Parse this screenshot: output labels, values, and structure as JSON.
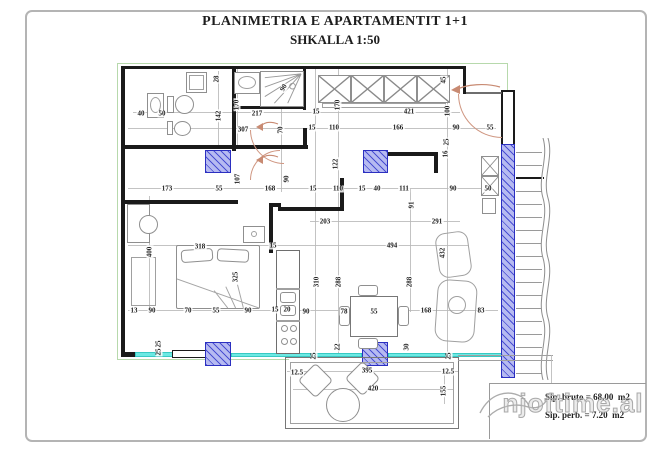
{
  "sheet": {
    "title_line1": "PLANIMETRIA E APARTAMENTIT 1+1",
    "title_line2": "SHKALLA 1:50"
  },
  "info": {
    "bruto": "Sip. bruto = 68.00  m2",
    "perb": "Sip. perb. = 7.20  m2"
  },
  "watermark": "njoftime.al",
  "colors": {
    "wall": "#1a1a1a",
    "column_fill": "#b6baf1",
    "column_border": "#2b2fc0",
    "window": "#6ce9e3",
    "door_arc": "#cf9681",
    "outline_green": "#b7d9ac",
    "furniture": "#8f8f8f",
    "dimension_text": "#1c1c1c"
  },
  "dims": [
    {
      "v": "28",
      "x": 217,
      "y": 79,
      "r": 1
    },
    {
      "v": "170",
      "x": 237,
      "y": 105,
      "r": 1
    },
    {
      "v": "40",
      "x": 141,
      "y": 114
    },
    {
      "v": "50",
      "x": 162,
      "y": 114
    },
    {
      "v": "142",
      "x": 219,
      "y": 116,
      "r": 1
    },
    {
      "v": "217",
      "x": 257,
      "y": 114
    },
    {
      "v": "90",
      "x": 284,
      "y": 88,
      "a": -60
    },
    {
      "v": "307",
      "x": 243,
      "y": 130
    },
    {
      "v": "70",
      "x": 281,
      "y": 130,
      "r": 1
    },
    {
      "v": "15",
      "x": 316,
      "y": 112
    },
    {
      "v": "170",
      "x": 338,
      "y": 105,
      "r": 1
    },
    {
      "v": "421",
      "x": 409,
      "y": 112
    },
    {
      "v": "100",
      "x": 448,
      "y": 111,
      "r": 1
    },
    {
      "v": "45",
      "x": 444,
      "y": 80,
      "r": 1
    },
    {
      "v": "15",
      "x": 312,
      "y": 128
    },
    {
      "v": "110",
      "x": 334,
      "y": 128
    },
    {
      "v": "166",
      "x": 398,
      "y": 128
    },
    {
      "v": "90",
      "x": 456,
      "y": 128
    },
    {
      "v": "55",
      "x": 490,
      "y": 128
    },
    {
      "v": "25",
      "x": 447,
      "y": 142,
      "r": 1
    },
    {
      "v": "16",
      "x": 446,
      "y": 154,
      "r": 1
    },
    {
      "v": "122",
      "x": 336,
      "y": 164,
      "r": 1
    },
    {
      "v": "107",
      "x": 238,
      "y": 179,
      "r": 1
    },
    {
      "v": "90",
      "x": 287,
      "y": 179,
      "r": 1
    },
    {
      "v": "173",
      "x": 167,
      "y": 189
    },
    {
      "v": "55",
      "x": 219,
      "y": 189
    },
    {
      "v": "168",
      "x": 270,
      "y": 189
    },
    {
      "v": "15",
      "x": 313,
      "y": 189
    },
    {
      "v": "110",
      "x": 338,
      "y": 189
    },
    {
      "v": "15",
      "x": 362,
      "y": 189
    },
    {
      "v": "40",
      "x": 377,
      "y": 189
    },
    {
      "v": "111",
      "x": 404,
      "y": 189
    },
    {
      "v": "90",
      "x": 453,
      "y": 189
    },
    {
      "v": "50",
      "x": 488,
      "y": 189
    },
    {
      "v": "91",
      "x": 412,
      "y": 205,
      "r": 1
    },
    {
      "v": "203",
      "x": 325,
      "y": 222
    },
    {
      "v": "291",
      "x": 437,
      "y": 222
    },
    {
      "v": "318",
      "x": 200,
      "y": 247
    },
    {
      "v": "15",
      "x": 273,
      "y": 246
    },
    {
      "v": "494",
      "x": 392,
      "y": 246
    },
    {
      "v": "400",
      "x": 150,
      "y": 252,
      "r": 1
    },
    {
      "v": "325",
      "x": 236,
      "y": 277,
      "r": 1
    },
    {
      "v": "432",
      "x": 443,
      "y": 253,
      "r": 1
    },
    {
      "v": "310",
      "x": 317,
      "y": 282,
      "r": 1
    },
    {
      "v": "288",
      "x": 339,
      "y": 282,
      "r": 1
    },
    {
      "v": "288",
      "x": 410,
      "y": 282,
      "r": 1
    },
    {
      "v": "13",
      "x": 134,
      "y": 311
    },
    {
      "v": "90",
      "x": 152,
      "y": 311
    },
    {
      "v": "70",
      "x": 188,
      "y": 311
    },
    {
      "v": "55",
      "x": 216,
      "y": 311
    },
    {
      "v": "90",
      "x": 248,
      "y": 311
    },
    {
      "v": "15",
      "x": 275,
      "y": 310
    },
    {
      "v": "20",
      "x": 287,
      "y": 310
    },
    {
      "v": "90",
      "x": 306,
      "y": 312
    },
    {
      "v": "78",
      "x": 344,
      "y": 312
    },
    {
      "v": "55",
      "x": 374,
      "y": 312
    },
    {
      "v": "168",
      "x": 426,
      "y": 311
    },
    {
      "v": "83",
      "x": 481,
      "y": 311
    },
    {
      "v": "25",
      "x": 159,
      "y": 344,
      "r": 1
    },
    {
      "v": "25",
      "x": 159,
      "y": 352,
      "r": 1
    },
    {
      "v": "25",
      "x": 314,
      "y": 356,
      "r": 1
    },
    {
      "v": "22",
      "x": 338,
      "y": 347,
      "r": 1
    },
    {
      "v": "30",
      "x": 407,
      "y": 347,
      "r": 1
    },
    {
      "v": "25",
      "x": 449,
      "y": 356,
      "r": 1
    },
    {
      "v": "12.5",
      "x": 297,
      "y": 373
    },
    {
      "v": "395",
      "x": 367,
      "y": 371
    },
    {
      "v": "420",
      "x": 373,
      "y": 389
    },
    {
      "v": "12.5",
      "x": 448,
      "y": 372
    },
    {
      "v": "155",
      "x": 444,
      "y": 391,
      "r": 1
    }
  ]
}
